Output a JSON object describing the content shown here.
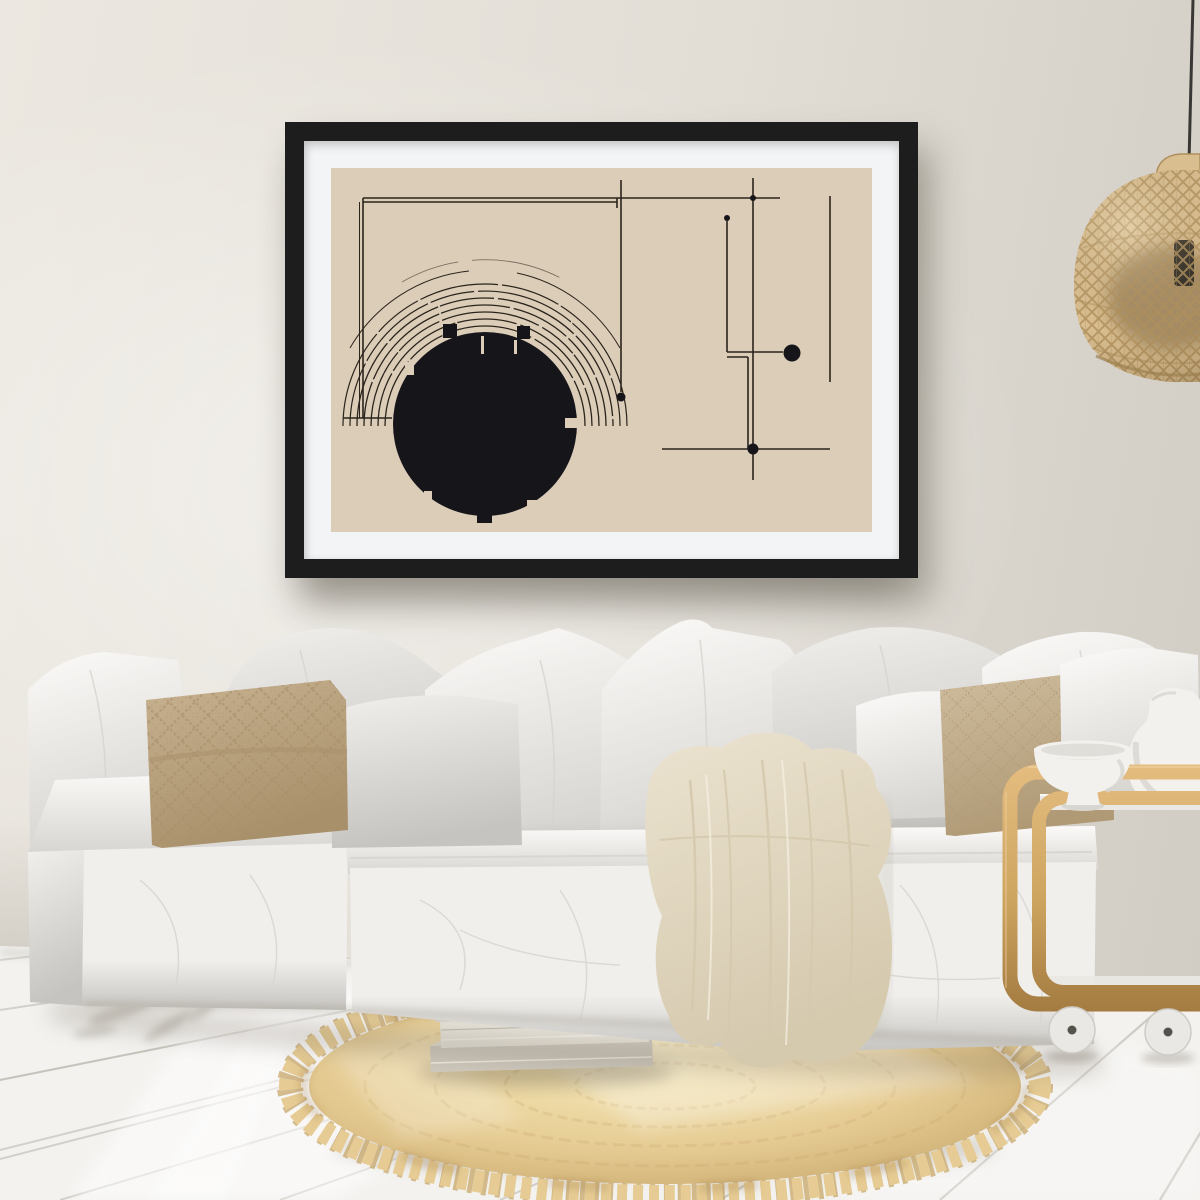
{
  "meta": {
    "description": "Bright scandinavian living room: white slipcovered modular sofa with linen pillows, framed abstract geometric line-art poster in a black frame on a warm grey wall, rattan pendant lamp, wooden bar cart with white ceramics, round jute rug with fringe and a stack of books on white plank flooring.",
    "width": 1200,
    "height": 1200
  },
  "colors": {
    "wall": "#e2ded6",
    "wall_light": "#ece8e1",
    "wall_dark": "#d0ccc4",
    "frame_black": "#1d1d1d",
    "mat_white": "#f3f4f6",
    "art_bg": "#dccdb8",
    "art_ink": "#2a241c",
    "art_black": "#15151a",
    "sofa_white": "#f0efec",
    "sofa_highlight": "#fbfaf8",
    "sofa_shadow": "#d8d6d2",
    "sofa_deep": "#c6c4c0",
    "pillow_beige": "#c8b291",
    "pillow_beige_dark": "#a8906a",
    "pillow_beige2": "#cfbd9e",
    "pillow_beige2_dark": "#b09a76",
    "throw_cream": "#ebe3d0",
    "throw_shadow": "#d5c9ae",
    "wood": "#cda45f",
    "wood_light": "#e5bd80",
    "wood_dark": "#a37a40",
    "ceramic_white": "#f2f1ee",
    "ceramic_shadow": "#d8d6d1",
    "rug_base": "#e6cc94",
    "rug_light": "#f5e7b6",
    "rug_dark": "#c7a76a",
    "floor_white": "#f3f2ef",
    "floor_line": "#bfbbb3",
    "rattan": "#d9be90",
    "rattan_dark": "#b0905c",
    "rattan_deep": "#7c6543",
    "cord_dark": "#3a3836",
    "wheel_grey": "#e9e8e4"
  },
  "scene": {
    "wall": {
      "label": "warm grey plaster wall"
    },
    "poster": {
      "label": "black framed abstract geometric line-art poster with white mat",
      "elements": [
        "large black circle with notched rim",
        "concentric sketched arcs above the circle",
        "open double-line rectangle outline",
        "vertical construction lines with small dots",
        "large black dot on a right-angle connector",
        "crosshair intersection with dot at lower right"
      ]
    },
    "lamp": {
      "label": "woven rattan pendant lamp with black cord, partially out of frame"
    },
    "sofa": {
      "label": "white slipcovered modular linen sofa",
      "pillows": [
        "white linen pillow (left corner)",
        "beige diamond-knit pillow (left front)",
        "white linen pillow (behind beige)",
        "light grey linen pillow (mid front)",
        "white peaked pillow (center)",
        "tall white pillow with sheen (center back)",
        "white linen pillow (right back)",
        "small white pillow (right front)",
        "beige stitched pillow (right front)",
        "white pillow (far right)"
      ]
    },
    "throw": {
      "label": "cream throw blanket draped over the seat edge"
    },
    "cart": {
      "label": "light oak bar cart side table on white wheels",
      "items": [
        "white pedestal bowl",
        "white ceramic jug"
      ]
    },
    "rug": {
      "label": "round braided jute rug with chunky fringe"
    },
    "books": {
      "label": "stack of books on the rug",
      "count": 5
    },
    "floor": {
      "label": "white-washed wooden plank floor with sunlight streaks"
    }
  }
}
